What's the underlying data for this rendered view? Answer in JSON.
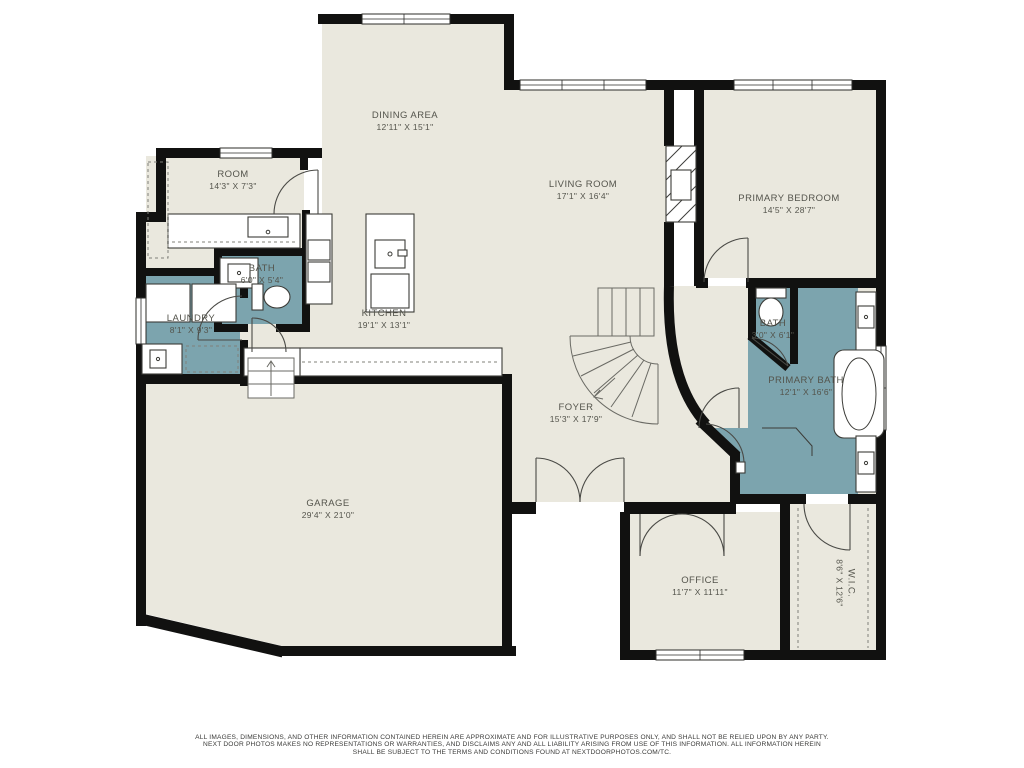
{
  "document_type": "residential-floor-plan",
  "colors": {
    "background": "#ffffff",
    "floor": "#eae8de",
    "wet_rooms": "#7ca4ae",
    "walls": "#111110",
    "label_text": "#54544c"
  },
  "rooms": [
    {
      "name": "DINING AREA",
      "dims": "12'11\" X 15'1\""
    },
    {
      "name": "ROOM",
      "dims": "14'3\" X 7'3\""
    },
    {
      "name": "LIVING ROOM",
      "dims": "17'1\" X 16'4\""
    },
    {
      "name": "PRIMARY BEDROOM",
      "dims": "14'5\" X 28'7\""
    },
    {
      "name": "BATH",
      "dims": "6'0\" X 5'4\""
    },
    {
      "name": "LAUNDRY",
      "dims": "8'1\" X 9'3\""
    },
    {
      "name": "KITCHEN",
      "dims": "19'1\" X 13'1\""
    },
    {
      "name": "BATH",
      "dims": "3'0\" X 6'1\""
    },
    {
      "name": "PRIMARY BATH",
      "dims": "12'1\" X 16'6\""
    },
    {
      "name": "FOYER",
      "dims": "15'3\" X 17'9\""
    },
    {
      "name": "GARAGE",
      "dims": "29'4\" X 21'0\""
    },
    {
      "name": "OFFICE",
      "dims": "11'7\" X 11'11\""
    },
    {
      "name": "W.I.C.",
      "dims": "8'6\" X 12'6\""
    }
  ],
  "disclaimer": {
    "line1": "ALL IMAGES, DIMENSIONS, AND OTHER INFORMATION CONTAINED HEREIN ARE APPROXIMATE AND FOR ILLUSTRATIVE PURPOSES ONLY, AND SHALL NOT BE RELIED UPON BY ANY PARTY.",
    "line2": "NEXT DOOR PHOTOS MAKES NO REPRESENTATIONS OR WARRANTIES, AND DISCLAIMS ANY AND ALL LIABILITY ARISING FROM USE OF THIS INFORMATION. ALL INFORMATION HEREIN",
    "line3": "SHALL BE SUBJECT TO THE TERMS AND CONDITIONS FOUND AT NEXTDOORPHOTOS.COM/TC."
  }
}
